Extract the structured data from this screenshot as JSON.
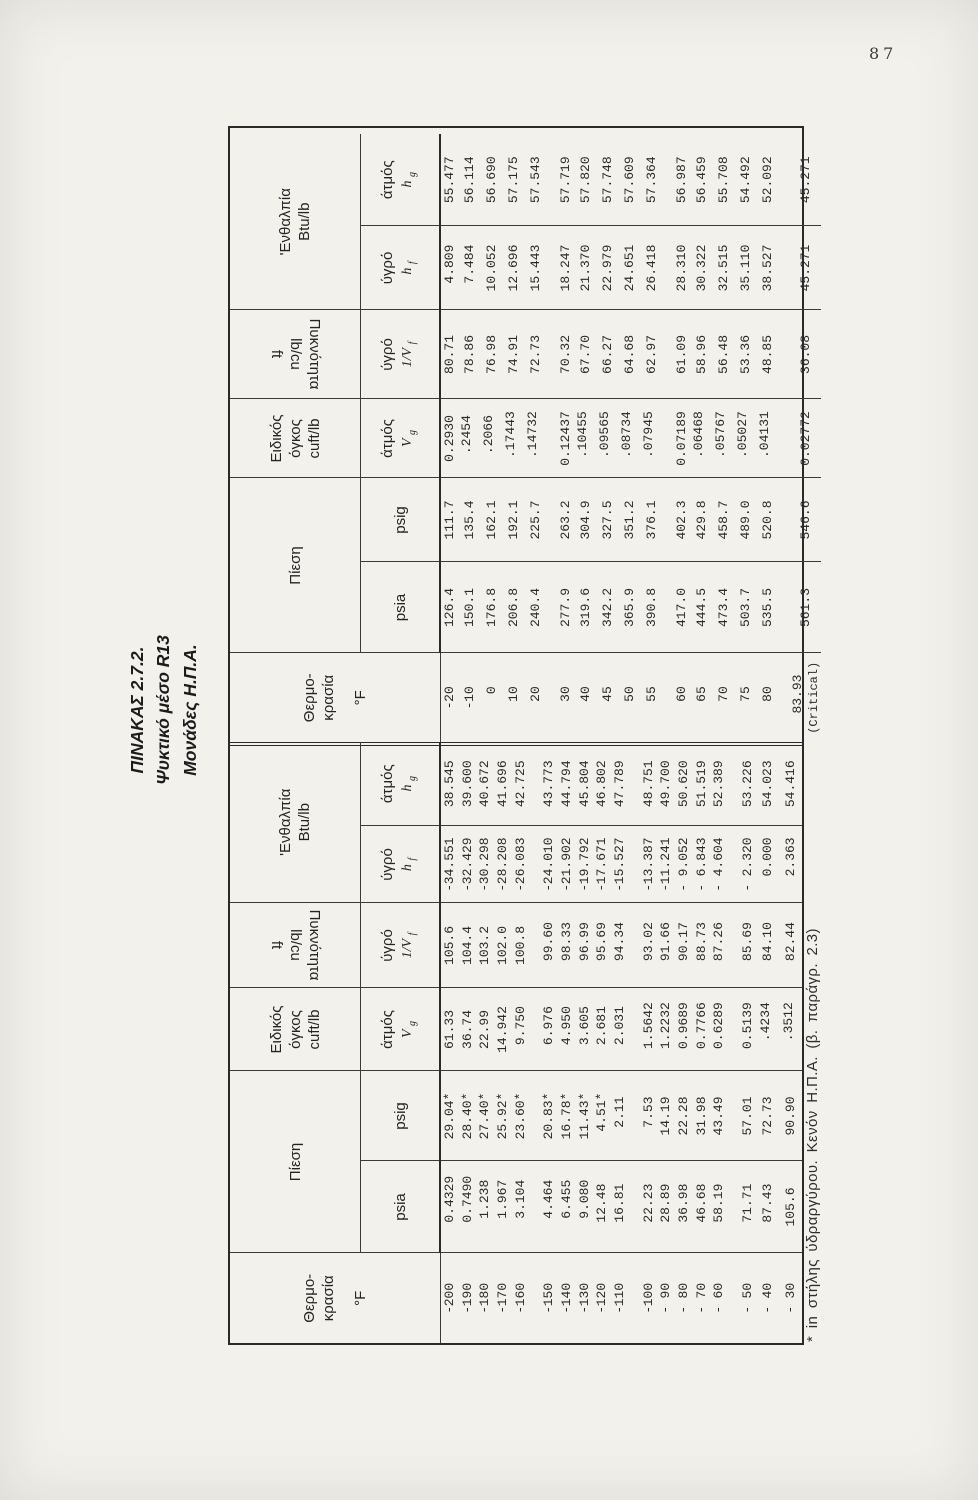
{
  "page": {
    "number": "87"
  },
  "colors": {
    "paper": "#f2f1ec",
    "ink": "#2a2a2a"
  },
  "title": {
    "line1": "ΠΙΝΑΚΑΣ 2.7.2.",
    "line2": "Ψυκτικό μέσο R13",
    "line3": "Μονάδες Η.Π.Α."
  },
  "footnote": "* in στήλης ύδραργύρου. Κενόν Η.Π.Α. (β. παράγρ. 2.3)",
  "table": {
    "headers": {
      "temperature": {
        "lines": [
          "Θερμο-",
          "κρασία",
          "°F"
        ]
      },
      "pressure": "Πίεση",
      "specific_volume": {
        "lines": [
          "Ειδικός",
          "όγκος",
          "cuft/lb"
        ]
      },
      "density": {
        "lines": [
          "Πυκνότητα",
          "lb/cu",
          "ft"
        ]
      },
      "enthalpy": {
        "lines": [
          "'Ενθαλπία",
          "Btu/lb"
        ]
      },
      "sub": {
        "psia": "psia",
        "psig": "psig",
        "vg": {
          "word": "άτμός",
          "sym": "V",
          "sub": "g"
        },
        "vf": {
          "word": "ύγρό",
          "sym": "1/V",
          "sub": "f"
        },
        "hf": {
          "word": "ύγρό",
          "sym": "h",
          "sub": "f"
        },
        "hg": {
          "word": "άτμός",
          "sym": "h",
          "sub": "g"
        }
      }
    },
    "columns": [
      "temperature_F",
      "psia",
      "psig",
      "Vg_cuft_lb",
      "1/Vf_lb_cuft",
      "hf_Btu_lb",
      "hg_Btu_lb"
    ],
    "half1": {
      "group_sizes": [
        5,
        5,
        5,
        3
      ],
      "rows": [
        [
          "-200",
          "0.4329",
          "29.04*",
          "61.33",
          "105.6",
          "-34.551",
          "38.545"
        ],
        [
          "-190",
          "0.7490",
          "28.40*",
          "36.74",
          "104.4",
          "-32.429",
          "39.600"
        ],
        [
          "-180",
          "1.238",
          "27.40*",
          "22.99",
          "103.2",
          "-30.298",
          "40.672"
        ],
        [
          "-170",
          "1.967",
          "25.92*",
          "14.942",
          "102.0",
          "-28.208",
          "41.696"
        ],
        [
          "-160",
          "3.104",
          "23.60*",
          "9.750",
          "100.8",
          "-26.083",
          "42.725"
        ],
        [
          "-150",
          "4.464",
          "20.83*",
          "6.976",
          "99.60",
          "-24.010",
          "43.773"
        ],
        [
          "-140",
          "6.455",
          "16.78*",
          "4.950",
          "98.33",
          "-21.902",
          "44.794"
        ],
        [
          "-130",
          "9.080",
          "11.43*",
          "3.605",
          "96.99",
          "-19.792",
          "45.804"
        ],
        [
          "-120",
          "12.48",
          "4.51*",
          "2.681",
          "95.69",
          "-17.671",
          "46.802"
        ],
        [
          "-110",
          "16.81",
          "2.11",
          "2.031",
          "94.34",
          "-15.527",
          "47.789"
        ],
        [
          "-100",
          "22.23",
          "7.53",
          "1.5642",
          "93.02",
          "-13.387",
          "48.751"
        ],
        [
          "-90",
          "28.89",
          "14.19",
          "1.2232",
          "91.66",
          "-11.241",
          "49.700"
        ],
        [
          "-80",
          "36.98",
          "22.28",
          "0.9689",
          "90.17",
          "-9.052",
          "50.620"
        ],
        [
          "-70",
          "46.68",
          "31.98",
          "0.7766",
          "88.73",
          "-6.843",
          "51.519"
        ],
        [
          "-60",
          "58.19",
          "43.49",
          "0.6289",
          "87.26",
          "-4.604",
          "52.389"
        ],
        [
          "-50",
          "71.71",
          "57.01",
          "0.5139",
          "85.69",
          "-2.320",
          "53.226"
        ],
        [
          "-40",
          "87.43",
          "72.73",
          ".4234",
          "84.10",
          "0.000",
          "54.023"
        ],
        [
          "-30",
          "105.6",
          "90.90",
          ".3512",
          "82.44",
          "2.363",
          "54.416"
        ]
      ]
    },
    "half2": {
      "group_sizes": [
        5,
        5,
        5,
        1
      ],
      "critical_note": "(Critical)",
      "rows": [
        [
          "-20",
          "126.4",
          "111.7",
          "0.2930",
          "80.71",
          "4.809",
          "55.477"
        ],
        [
          "-10",
          "150.1",
          "135.4",
          ".2454",
          "78.86",
          "7.484",
          "56.114"
        ],
        [
          "0",
          "176.8",
          "162.1",
          ".2066",
          "76.98",
          "10.052",
          "56.690"
        ],
        [
          "10",
          "206.8",
          "192.1",
          ".17443",
          "74.91",
          "12.696",
          "57.175"
        ],
        [
          "20",
          "240.4",
          "225.7",
          ".14732",
          "72.73",
          "15.443",
          "57.543"
        ],
        [
          "30",
          "277.9",
          "263.2",
          "0.12437",
          "70.32",
          "18.247",
          "57.719"
        ],
        [
          "40",
          "319.6",
          "304.9",
          ".10455",
          "67.70",
          "21.370",
          "57.820"
        ],
        [
          "45",
          "342.2",
          "327.5",
          ".09565",
          "66.27",
          "22.979",
          "57.748"
        ],
        [
          "50",
          "365.9",
          "351.2",
          ".08734",
          "64.68",
          "24.651",
          "57.609"
        ],
        [
          "55",
          "390.8",
          "376.1",
          ".07945",
          "62.97",
          "26.418",
          "57.364"
        ],
        [
          "60",
          "417.0",
          "402.3",
          "0.07189",
          "61.09",
          "28.310",
          "56.987"
        ],
        [
          "65",
          "444.5",
          "429.8",
          ".06468",
          "58.96",
          "30.322",
          "56.459"
        ],
        [
          "70",
          "473.4",
          "458.7",
          ".05767",
          "56.48",
          "32.515",
          "55.708"
        ],
        [
          "75",
          "503.7",
          "489.0",
          ".05027",
          "53.36",
          "35.110",
          "54.492"
        ],
        [
          "80",
          "535.5",
          "520.8",
          ".04131",
          "48.85",
          "38.527",
          "52.092"
        ],
        [
          "83.93",
          "561.3",
          "546.6",
          "0.02772",
          "36.08",
          "45.271",
          "45.271"
        ]
      ]
    }
  }
}
